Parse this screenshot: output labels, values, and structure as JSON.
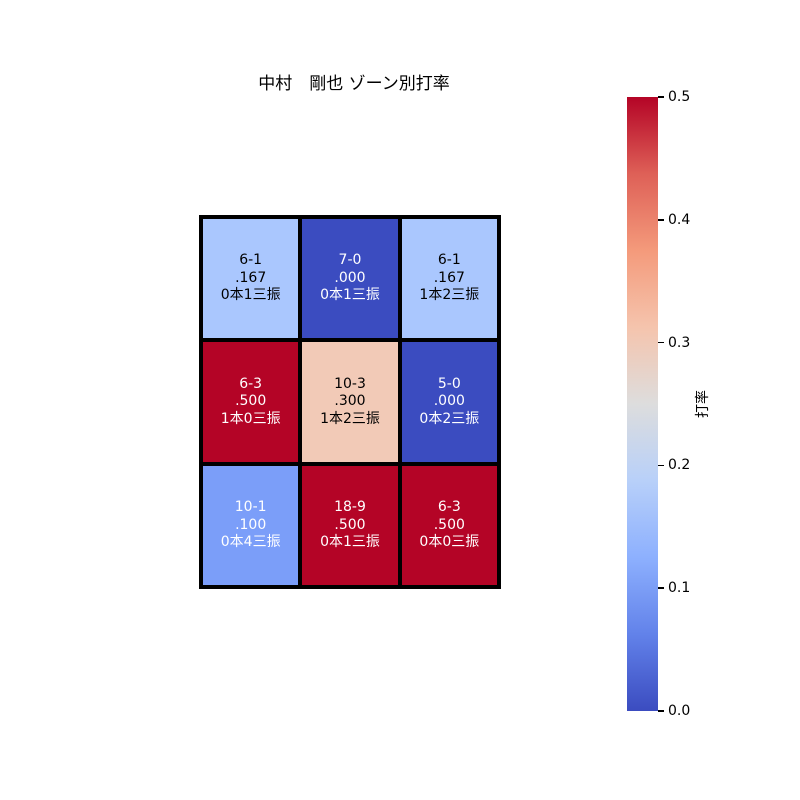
{
  "title": "中村　剛也 ゾーン別打率",
  "chart_data": {
    "type": "heatmap",
    "title": "中村　剛也 ゾーン別打率",
    "rows": 3,
    "cols": 3,
    "cells": [
      [
        {
          "record": "6-1",
          "avg": ".167",
          "note": "0本1三振",
          "value": 0.167,
          "bg": "#aac7fe",
          "fg": "#000000"
        },
        {
          "record": "7-0",
          "avg": ".000",
          "note": "0本1三振",
          "value": 0.0,
          "bg": "#3b4cc0",
          "fg": "#ffffff"
        },
        {
          "record": "6-1",
          "avg": ".167",
          "note": "1本2三振",
          "value": 0.167,
          "bg": "#aac7fe",
          "fg": "#000000"
        }
      ],
      [
        {
          "record": "6-3",
          "avg": ".500",
          "note": "1本0三振",
          "value": 0.5,
          "bg": "#b40426",
          "fg": "#ffffff"
        },
        {
          "record": "10-3",
          "avg": ".300",
          "note": "1本2三振",
          "value": 0.3,
          "bg": "#f2cab7",
          "fg": "#000000"
        },
        {
          "record": "5-0",
          "avg": ".000",
          "note": "0本2三振",
          "value": 0.0,
          "bg": "#3b4cc0",
          "fg": "#ffffff"
        }
      ],
      [
        {
          "record": "10-1",
          "avg": ".100",
          "note": "0本4三振",
          "value": 0.1,
          "bg": "#7b9ef9",
          "fg": "#ffffff"
        },
        {
          "record": "18-9",
          "avg": ".500",
          "note": "0本1三振",
          "value": 0.5,
          "bg": "#b40426",
          "fg": "#ffffff"
        },
        {
          "record": "6-3",
          "avg": ".500",
          "note": "0本0三振",
          "value": 0.5,
          "bg": "#b40426",
          "fg": "#ffffff"
        }
      ]
    ],
    "colorbar": {
      "label": "打率",
      "vmin": 0.0,
      "vmax": 0.5,
      "ticks": [
        "0.5",
        "0.4",
        "0.3",
        "0.2",
        "0.1",
        "0.0"
      ],
      "colormap": "coolwarm",
      "gradient_stops_bottom_to_top": [
        "#3b4cc0",
        "#6282ea",
        "#8db0fe",
        "#b8d0f9",
        "#dddddd",
        "#f5c4ad",
        "#f49a7b",
        "#de6057",
        "#b40426"
      ]
    },
    "grid": false,
    "legend": false
  }
}
